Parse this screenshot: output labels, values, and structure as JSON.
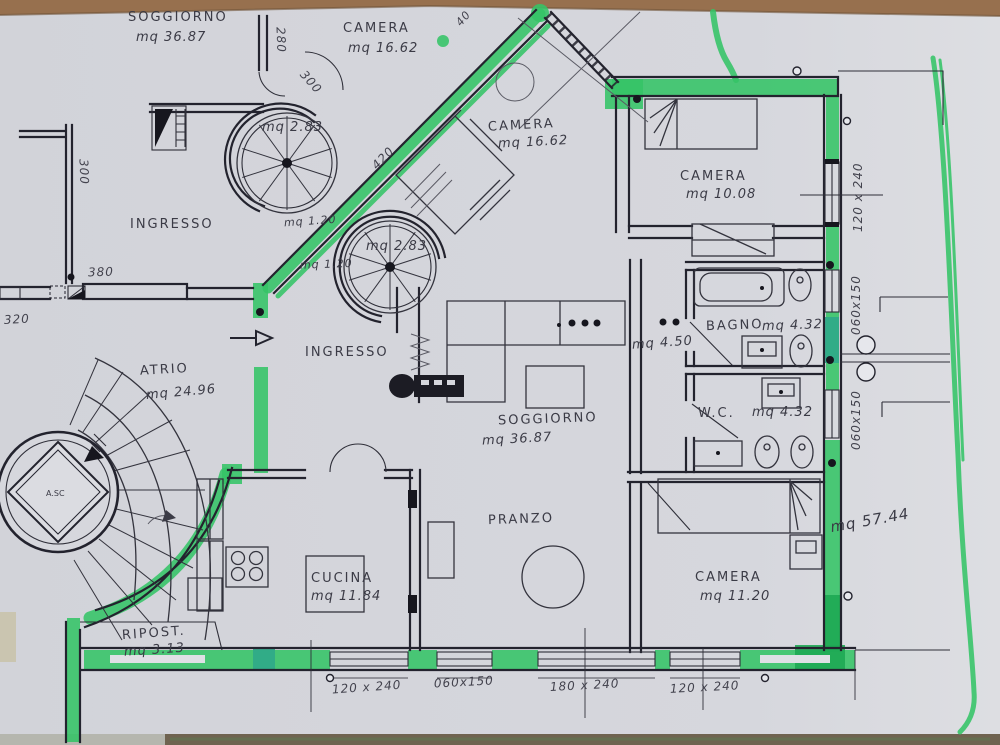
{
  "colors": {
    "marker_green": "#34c467",
    "marker_green_dark": "#1ea854",
    "marker_teal": "#2fa98a",
    "paper": "#d4d5db",
    "ink": "#23232e",
    "pencil": "#5a5a64",
    "table_wood": "#97704e"
  },
  "rooms": {
    "soggiorno_top": {
      "name": "SOGGIORNO",
      "area": "mq 36.87"
    },
    "camera_top": {
      "name": "CAMERA",
      "area": "mq 16.62"
    },
    "camera_diag": {
      "name": "CAMERA",
      "area": "mq 16.62"
    },
    "camera_right": {
      "name": "CAMERA",
      "area": "mq 10.08"
    },
    "camera_bottom": {
      "name": "CAMERA",
      "area": "mq 11.20"
    },
    "ingresso_left": {
      "name": "INGRESSO"
    },
    "ingresso_center": {
      "name": "INGRESSO"
    },
    "atrio": {
      "name": "ATRIO",
      "area": "mq 24.96"
    },
    "soggiorno_center": {
      "name": "SOGGIORNO",
      "area": "mq 36.87"
    },
    "pranzo": {
      "name": "PRANZO"
    },
    "cucina": {
      "name": "CUCINA",
      "area": "mq 11.84"
    },
    "ripostiglio": {
      "name": "RIPOST.",
      "area": "mq 3.13"
    },
    "bagno": {
      "name": "BAGNO",
      "area": "mq 4.32"
    },
    "wc": {
      "name": "W.C.",
      "area": "mq 4.32"
    },
    "disimpegno": {
      "area": "mq 4.50"
    },
    "terrazza": {
      "area": "mq 57.44"
    },
    "scala_chiocciola_1": {
      "area": "mq 2.83"
    },
    "scala_chiocciola_2": {
      "area": "mq 2.83"
    },
    "vano_a": {
      "area": "mq 1.20"
    },
    "vano_b": {
      "area": "mq 1.20"
    },
    "ascensore": {
      "name": "A.SC"
    }
  },
  "dimensions": {
    "d280": "280",
    "d300_scala": "300",
    "d300_muro": "300",
    "d420": "420",
    "d40": "40",
    "d380": "380",
    "d320": "320",
    "fin_dx_1": "120 x 240",
    "fin_dx_2": "060x150",
    "fin_dx_3": "060x150",
    "fin_sud_1": "120 x 240",
    "fin_sud_2": "060x150",
    "fin_sud_3": "180 x 240",
    "fin_sud_4": "120 x 240"
  }
}
